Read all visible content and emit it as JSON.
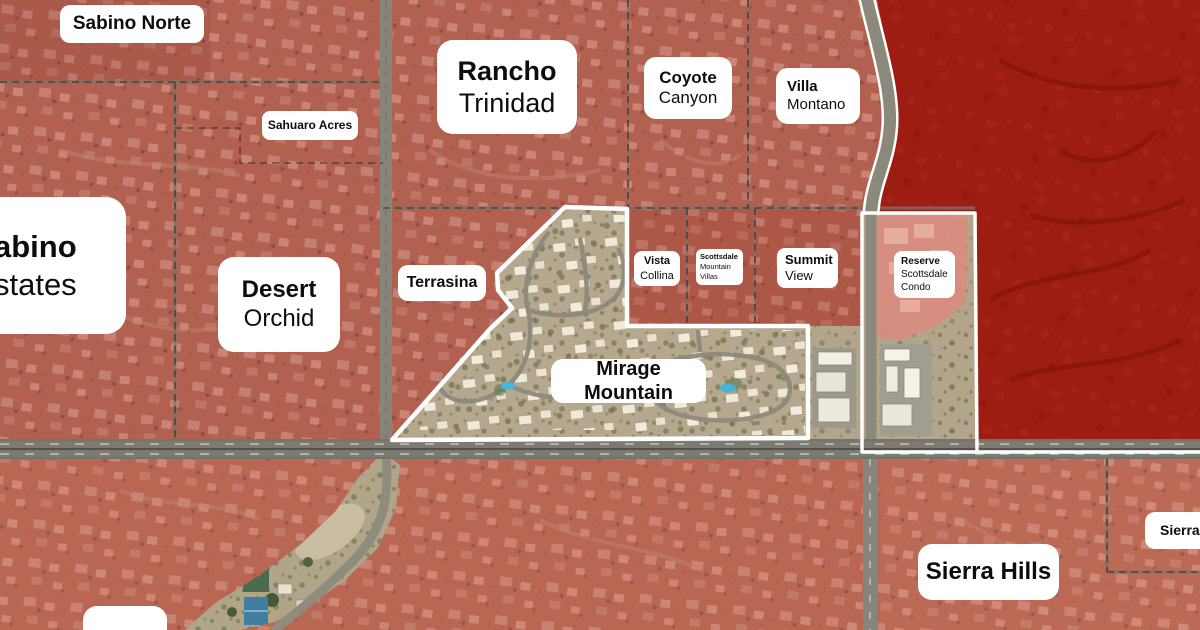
{
  "map": {
    "type": "aerial-neighborhood-overlay-map",
    "labels": {
      "sabino_norte": {
        "line1": "Sabino Norte"
      },
      "sahuaro_acres": {
        "line1": "Sahuaro Acres"
      },
      "rancho_trinidad": {
        "line1": "Rancho",
        "line2": "Trinidad"
      },
      "coyote_canyon": {
        "line1": "Coyote",
        "line2": "Canyon"
      },
      "villa_montano": {
        "line1": "Villa",
        "line2": "Montano"
      },
      "sabino_estates": {
        "line1": "Sabino",
        "line2": "Estates"
      },
      "desert_orchid": {
        "line1": "Desert",
        "line2": "Orchid"
      },
      "terrasina": {
        "line1": "Terrasina"
      },
      "vista_collina": {
        "line1": "Vista",
        "line2": "Collina"
      },
      "scottsdale_mountain_villas": {
        "line1": "Scottsdale",
        "line2": "Mountain",
        "line3": "Villas"
      },
      "summit_view": {
        "line1": "Summit",
        "line2": "View"
      },
      "reserve_scottsdale_condo": {
        "line1": "Reserve",
        "line2": "Scottsdale",
        "line3": "Condo"
      },
      "mirage_mountain": {
        "line1": "Mirage Mountain"
      },
      "sierra_hills": {
        "line1": "Sierra Hills"
      },
      "sierra_norte": {
        "line1": "Sierra Norte"
      }
    },
    "highlighted_area": "Mirage Mountain",
    "colors": {
      "overlay_red": "#b2604f",
      "overlay_dark_red": "#9e1d12",
      "overlay_light_red": "#d98b7e",
      "highlight_outline": "#ffffff",
      "aerial_tan": "#b6a88e",
      "label_bg": "#ffffff",
      "label_text": "#0d0d0d",
      "pool_blue": "#49b8d8"
    }
  }
}
